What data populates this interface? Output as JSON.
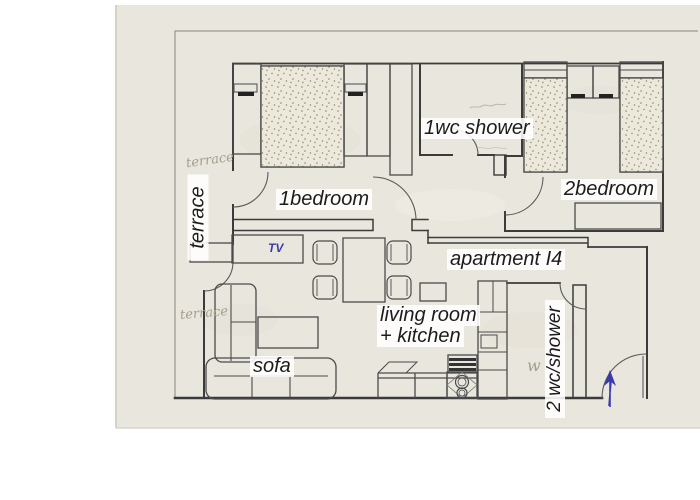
{
  "floorplan": {
    "apartment_label": "apartment I4",
    "labels": {
      "bedroom1": "1bedroom",
      "bedroom2": "2bedroom",
      "wc1": "1wc shower",
      "wc2": "2 wc/shower",
      "living_line1": "living room",
      "living_line2": "+ kitchen",
      "sofa": "sofa",
      "tv": "TV",
      "terrace_printed": "terrace",
      "terrace_pencil_top": "terrace",
      "terrace_pencil_bottom": "terrace",
      "pencil_w": "w"
    },
    "annotations": {
      "entrance_arrow_direction": "up",
      "entrance_arrow_color": "#3a3aad"
    },
    "colors": {
      "paper": "#e9e6de",
      "wall": "#3b3b3b",
      "furniture": "#4b4b4b",
      "ink_blue": "#3a3aad",
      "pencil": "#a79d8c",
      "label_bg": "#ffffff",
      "sheet_border": "#8d8778"
    }
  }
}
